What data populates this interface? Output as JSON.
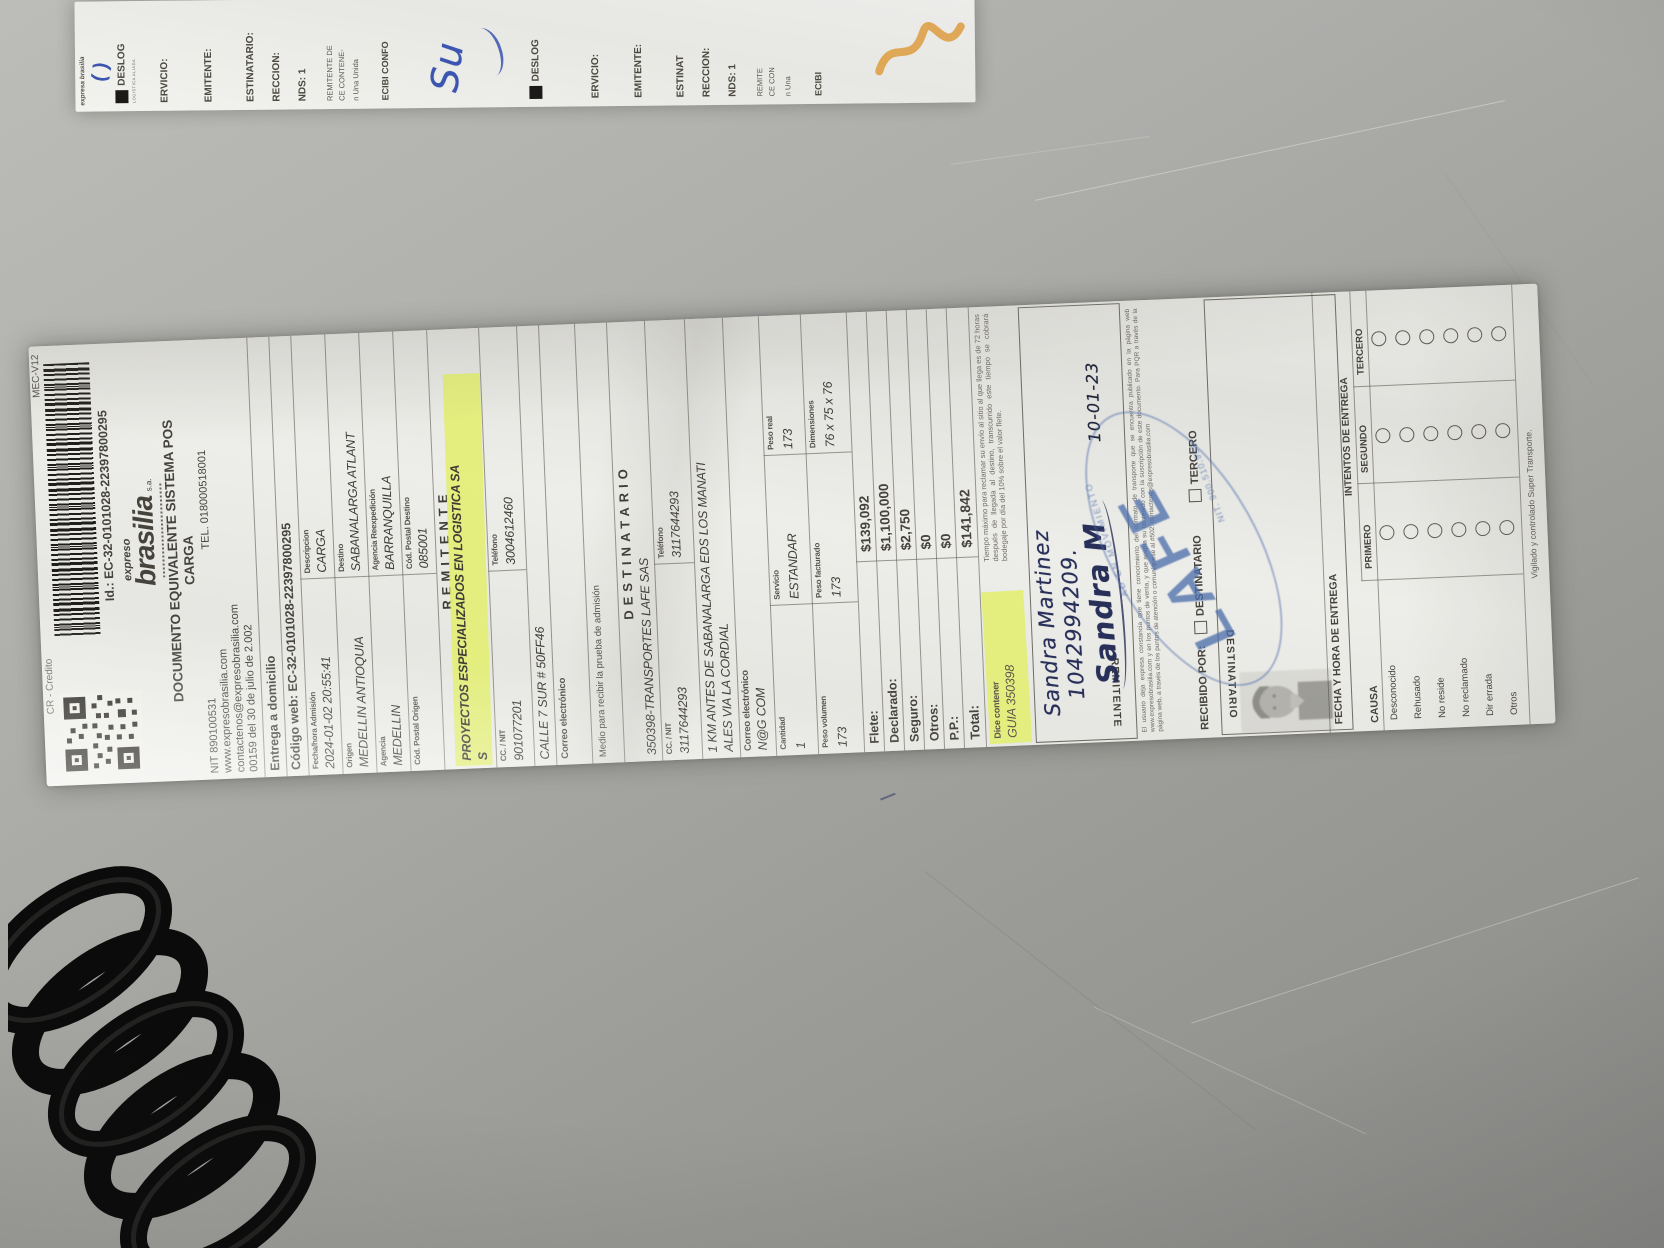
{
  "strip": {
    "pen_mark": "( )",
    "brand_small": "expresa brasilia",
    "left_logo": "DESLOG",
    "left_logo_sub": "LOGISTICA ALIADA",
    "left_fields": [
      "ERVICIO:",
      "EMITENTE:",
      "ESTINATARIO:",
      "RECCION:",
      "NDS: 1",
      "REMITENTE DE",
      "CE CONTENE-",
      "n Una Unida",
      "ECIBI CONFO"
    ],
    "handwriting": "Su",
    "right_logo": "DESLOG",
    "right_fields": [
      "ERVICIO:",
      "EMITENTE:",
      "ESTINAT",
      "RECCION:",
      "NDS: 1",
      "REMITE",
      "CE CON",
      "n Una",
      "ECIBI"
    ]
  },
  "r": {
    "credit": "CR - Credito",
    "form": "MEC-V12",
    "id_line": "Id.: EC-32-0101028-22397800295",
    "brand1": "expreso",
    "brand2": "brasilia",
    "brand3": "s.a.",
    "title": "DOCUMENTO EQUIVALENTE SISTEMA POS",
    "subtitle": "CARGA",
    "nit": "NIT 890100531",
    "tel": "TEL. 018000518001",
    "web": "www.expresobrasilia.com",
    "mail": "contactenos@expresobrasilia.com",
    "res": "00159 del 30 de julio de 2.002",
    "delivery": "Entrega a domicilio",
    "webcode": "Código web: EC-32-0101028-22397800295",
    "info": [
      {
        "l1": "Fecha/hora Admisión",
        "v1": "2024-01-02 20:55:41",
        "l2": "Descripcion",
        "v2": "CARGA"
      },
      {
        "l1": "Origen",
        "v1": "MEDELLIN ANTIOQUIA",
        "l2": "Destino",
        "v2": "SABANALARGA ATLANT"
      },
      {
        "l1": "Agencia",
        "v1": "MEDELLIN",
        "l2": "Agencia Reexpedición",
        "v2": "BARRANQUILLA"
      },
      {
        "l1": "Cód. Postal Origen",
        "v1": "",
        "l2": "Cód. Postal Destino",
        "v2": "085001"
      }
    ],
    "sender": {
      "t": "REMITENTE",
      "name1": "PROYECTOS ESPECIALIZADOS EN LOGISTICA SA",
      "name2": "S",
      "cc_label": "CC. / NIT",
      "cc": "901077201",
      "tel_label": "Teléfono",
      "tel": "3004612460",
      "addr": "CALLE 7 SUR # 50FF46",
      "mail_label": "Correo electrónico",
      "proof": "Medio para recibir la prueba de admisión"
    },
    "dest": {
      "t": "DESTINATARIO",
      "name": "350398-TRANSPORTES LAFE  SAS",
      "cc_label": "CC. / NIT",
      "cc": "3117644293",
      "tel_label": "Teléfono",
      "tel": "3117644293",
      "addr1": "1 KM ANTES DE SABANALARGA EDS LOS MANATI",
      "addr2": "ALES VIA LA CORDIAL",
      "mail_label": "Correo electrónico",
      "mail": "N@G COM"
    },
    "ship": {
      "q_l": "Cantidad",
      "q": "1",
      "s_l": "Servicio",
      "s": "ESTANDAR",
      "w_l": "Peso real",
      "w": "173",
      "v_l": "Peso volumen",
      "v": "173",
      "f_l": "Peso facturado",
      "f": "173",
      "d_l": "Dimensiones",
      "d": "76 x 75 x 76"
    },
    "charges": [
      [
        "Flete:",
        "$139,092"
      ],
      [
        "Declarado:",
        "$1,100,000"
      ],
      [
        "Seguro:",
        "$2,750"
      ],
      [
        "Otros:",
        "$0"
      ],
      [
        "P.P.:",
        "$0"
      ],
      [
        "Total:",
        "$141,842"
      ]
    ],
    "dice_label": "Dice contener",
    "dice_value": "GUIA 350398",
    "fine": "Tiempo máximo para reclamar su envío al sitio al que llega es de 72 horas después de llegada al destino, transcurrido este tiempo se cobrará bodegaje por día del 10% sobre el valor flete.",
    "hand": {
      "name": "Sandra Martinez",
      "id": "1042994209.",
      "sig": "Sandra M",
      "date": "10-01-23"
    },
    "rem_label": "REMITENTE",
    "legal": "El usuario deja expresa constancia que tiene conocimiento del contrato de transporte que se encuentra publicado en la página web www.expresobrasilia.com y en los puntos de venta, y que acepta su contenido con la suscripción de este documento. Para PQR a través de la página web, a través de los puntos de atención o comuníquese al #502. contactenos@expresobrasilia.com",
    "recibido": "RECIBIDO POR:",
    "opt1": "DESTINATARIO",
    "opt2": "TERCERO",
    "dest_label": "DESTINATARIO",
    "fecha_label": "FECHA Y HORA DE ENTREGA",
    "intentos": "INTENTOS DE ENTREGA",
    "cols": [
      "PRIMERO",
      "SEGUNDO",
      "TERCERO"
    ],
    "causa": "CAUSA",
    "causes": [
      "Desconocido",
      "Rehusado",
      "No reside",
      "No reclamado",
      "Dir errada",
      "Otros"
    ],
    "stamp": {
      "name": "LAFE",
      "arc": "AD EN MOVIMIENTO",
      "nit": "NIT. 900.510.959"
    },
    "footer": "Vigilado y controlado Super Transporte."
  }
}
